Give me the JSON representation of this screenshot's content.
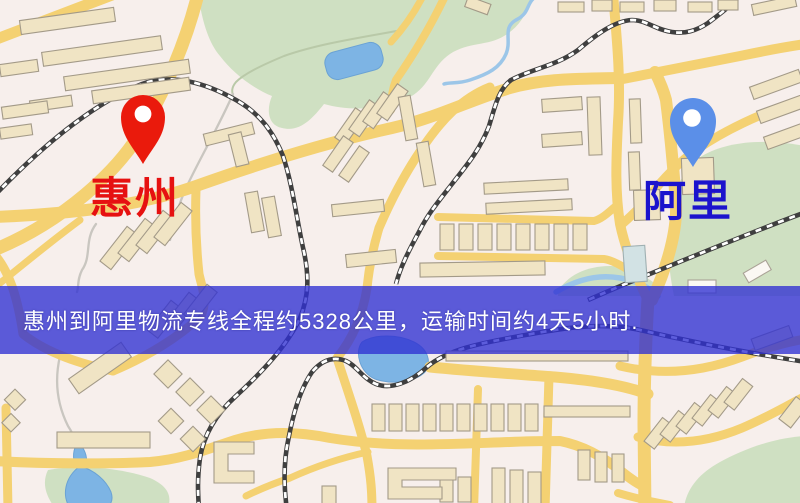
{
  "map": {
    "markers": {
      "origin": {
        "label": "惠州",
        "pin_color": "#ea1a0c",
        "label_color": "#e61111"
      },
      "destination": {
        "label": "阿里",
        "pin_color": "#5b8fe8",
        "label_color": "#1b13cd"
      }
    },
    "banner": {
      "text": "惠州到阿里物流专线全程约5328公里，运输时间约4天5小时.",
      "background_color": "rgba(47,47,210,0.78)",
      "text_color": "#ffffff"
    }
  },
  "palette": {
    "background": "#f7efec",
    "road": "#f4d172",
    "railway": "#3f3f3f",
    "park_green": "#cfe0c2",
    "water_blue": "#7db4e4",
    "building_tan": "#f0e4c4"
  }
}
